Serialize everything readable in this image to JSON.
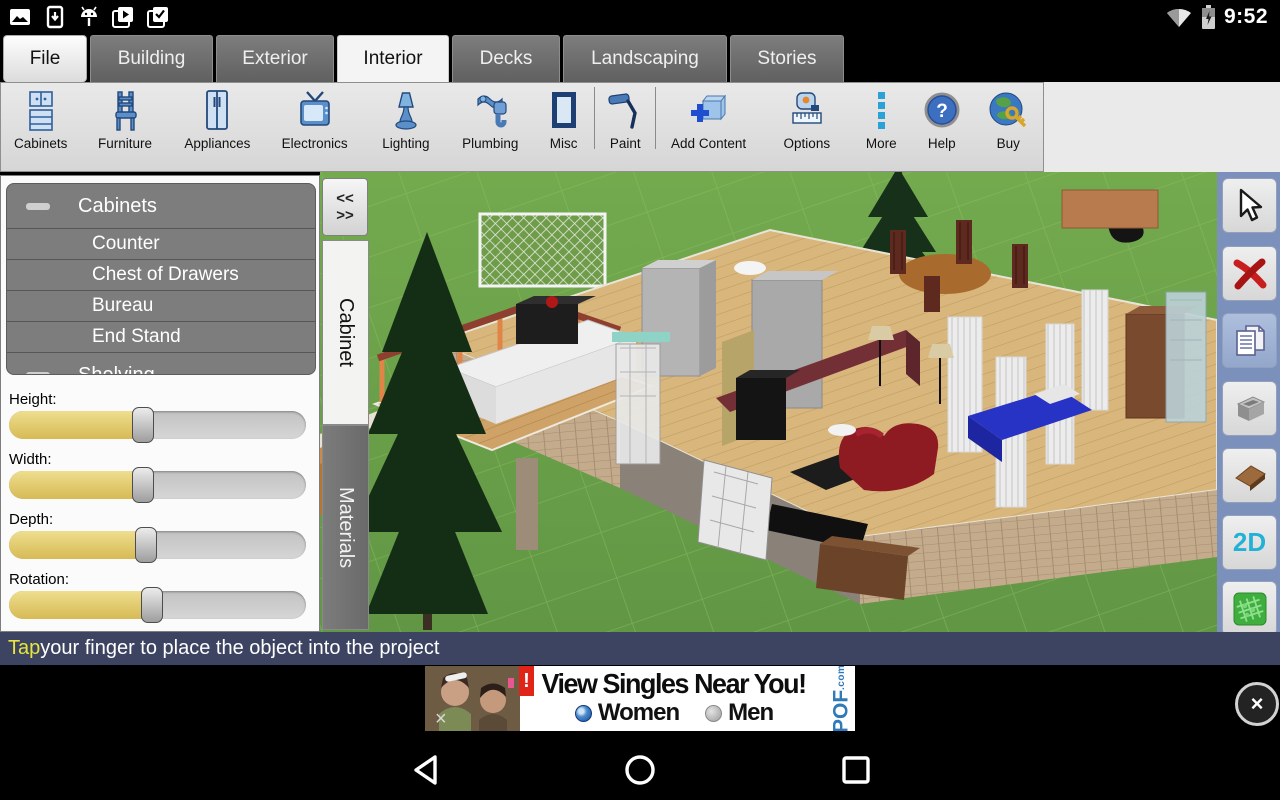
{
  "status_bar": {
    "time": "9:52"
  },
  "tab_bar": {
    "tabs": [
      {
        "label": "File"
      },
      {
        "label": "Building"
      },
      {
        "label": "Exterior"
      },
      {
        "label": "Interior",
        "active": true
      },
      {
        "label": "Decks"
      },
      {
        "label": "Landscaping"
      },
      {
        "label": "Stories"
      }
    ]
  },
  "toolbar": {
    "items": [
      {
        "label": "Cabinets"
      },
      {
        "label": "Furniture"
      },
      {
        "label": "Appliances"
      },
      {
        "label": "Electronics"
      },
      {
        "label": "Lighting"
      },
      {
        "label": "Plumbing"
      },
      {
        "label": "Misc"
      },
      {
        "label": "Paint"
      },
      {
        "label": "Add Content"
      },
      {
        "label": "Options"
      },
      {
        "label": "More"
      },
      {
        "label": "Help"
      },
      {
        "label": "Buy"
      }
    ],
    "help_glyph": "?"
  },
  "left_panel": {
    "list": {
      "group1": "Cabinets",
      "items": [
        {
          "label": "Counter"
        },
        {
          "label": "Chest of Drawers"
        },
        {
          "label": "Bureau"
        },
        {
          "label": "End Stand"
        }
      ],
      "group2": "Shelving"
    },
    "sliders": [
      {
        "label": "Height:",
        "value_pct": 45
      },
      {
        "label": "Width:",
        "value_pct": 45
      },
      {
        "label": "Depth:",
        "value_pct": 46
      },
      {
        "label": "Rotation:",
        "value_pct": 48
      }
    ]
  },
  "side_tabs": {
    "collapse_top": "<<",
    "collapse_bottom": ">>",
    "cabinet": "Cabinet",
    "materials": "Materials"
  },
  "right_toolbar": {
    "label_2d": "2D"
  },
  "hint_bar": {
    "highlight": "Tap",
    "text": " your finger to place the object into the project"
  },
  "ad": {
    "headline": "View Singles Near You!",
    "option_women": "Women",
    "option_men": "Men",
    "brand": "POF",
    "brand_tld": ".com",
    "badge": "!",
    "dismiss": "×"
  },
  "colors": {
    "toolbar_icon_blue": "#2e6db4",
    "slider_fill_yellow": "#ddc25e",
    "hint_bar_bg": "#3d4462",
    "hint_highlight": "#e6e63c",
    "right_strip_bg": "#7b90bb",
    "delete_red": "#c81e1e",
    "label_2d_cyan": "#23b2d6",
    "terrain_green": "#3fae3f",
    "ad_brand_blue": "#2f7ab8"
  }
}
